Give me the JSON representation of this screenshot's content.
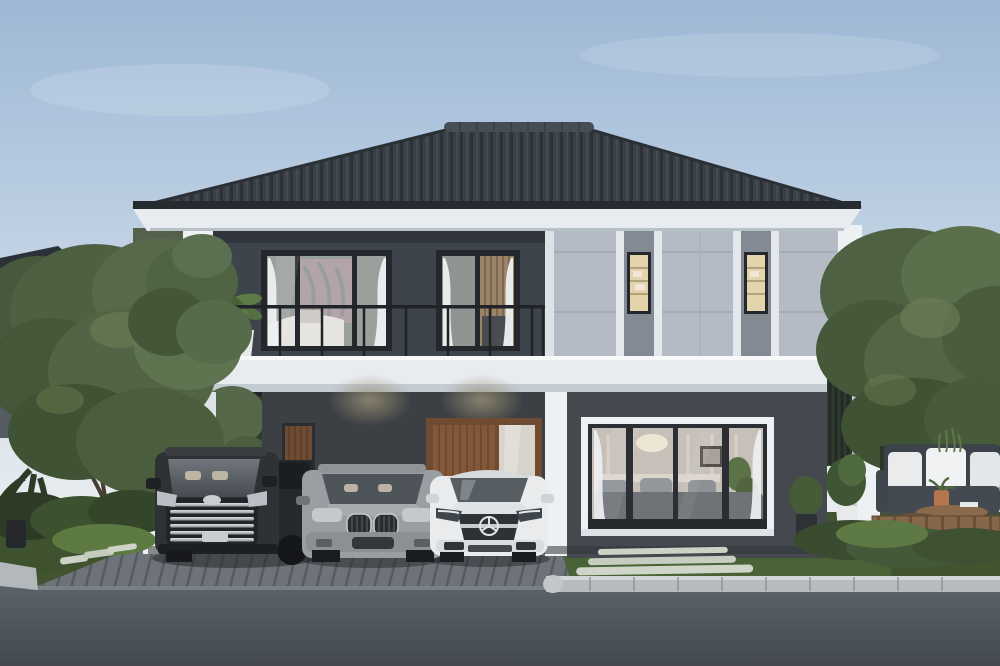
{
  "scene": {
    "type": "architectural-exterior-render",
    "time_of_day": "dusk",
    "description": "Photorealistic render of a modern two-storey house: dark charcoal upper-left facade with balcony, light grey panelled right facade with narrow lit windows, white floor band and carport frame, wooden front door, large sliding glass wall showing a classic living room, three cars parked in front (black van, grey SUV, white sedan), landscaped garden with patio sofa and wooden deck, lawn with stepping stones, driveway and asphalt road",
    "objects": [
      "sky",
      "hip-roof",
      "roof-fascia",
      "upper-dark-wall",
      "upper-light-wall",
      "bedroom-window",
      "hallway-window",
      "narrow-window-left",
      "narrow-window-right",
      "balcony-railing",
      "balcony-plant",
      "white-floor-band",
      "carport",
      "carport-columns",
      "front-door",
      "door-sidelight",
      "wood-decor-panel",
      "sliding-glass-wall",
      "living-room-interior",
      "louver-screen",
      "corner-column",
      "black-van",
      "grey-suv",
      "white-sedan",
      "neighbor-house",
      "distant-white-house",
      "left-garden-trees",
      "right-garden-trees",
      "patio-sofa",
      "wood-deck",
      "coffee-table",
      "potted-plants",
      "lawn",
      "stepping-stones",
      "driveway",
      "curb",
      "road"
    ]
  },
  "palette": {
    "sky_top": "#9db8d5",
    "sky_mid": "#c9d8e7",
    "sky_horizon": "#f0f2f1",
    "roof": "#394047",
    "fascia": "#e8ecf0",
    "wall_dark": "#3e444b",
    "wall_dark_lower": "#45494f",
    "wall_light": "#b4bbc4",
    "wall_light_strip": "#828a94",
    "band_white": "#e8ecef",
    "trim_white": "#eef1f4",
    "window_frame": "#24272b",
    "warm_light": "#e4d4ab",
    "door_wood": "#82573a",
    "curtain": "#edf0f2",
    "interior_wall": "#c6c0b9",
    "hedge": "#2e3c2a",
    "grass_dark": "#3f5230",
    "lawn": "#4a6336",
    "stone": "#ccd2c5",
    "driveway": "#6e7379",
    "curb": "#b6bbc0",
    "road": "#51575e",
    "van_body": "#2e3235",
    "suv_body": "#999ea3",
    "sedan_body": "#e9ebed",
    "deck_wood": "#87674a",
    "sofa": "#434a51",
    "pillow": "#e9ebec",
    "terracotta": "#b5764f",
    "pot_white": "#e7e9ea"
  }
}
